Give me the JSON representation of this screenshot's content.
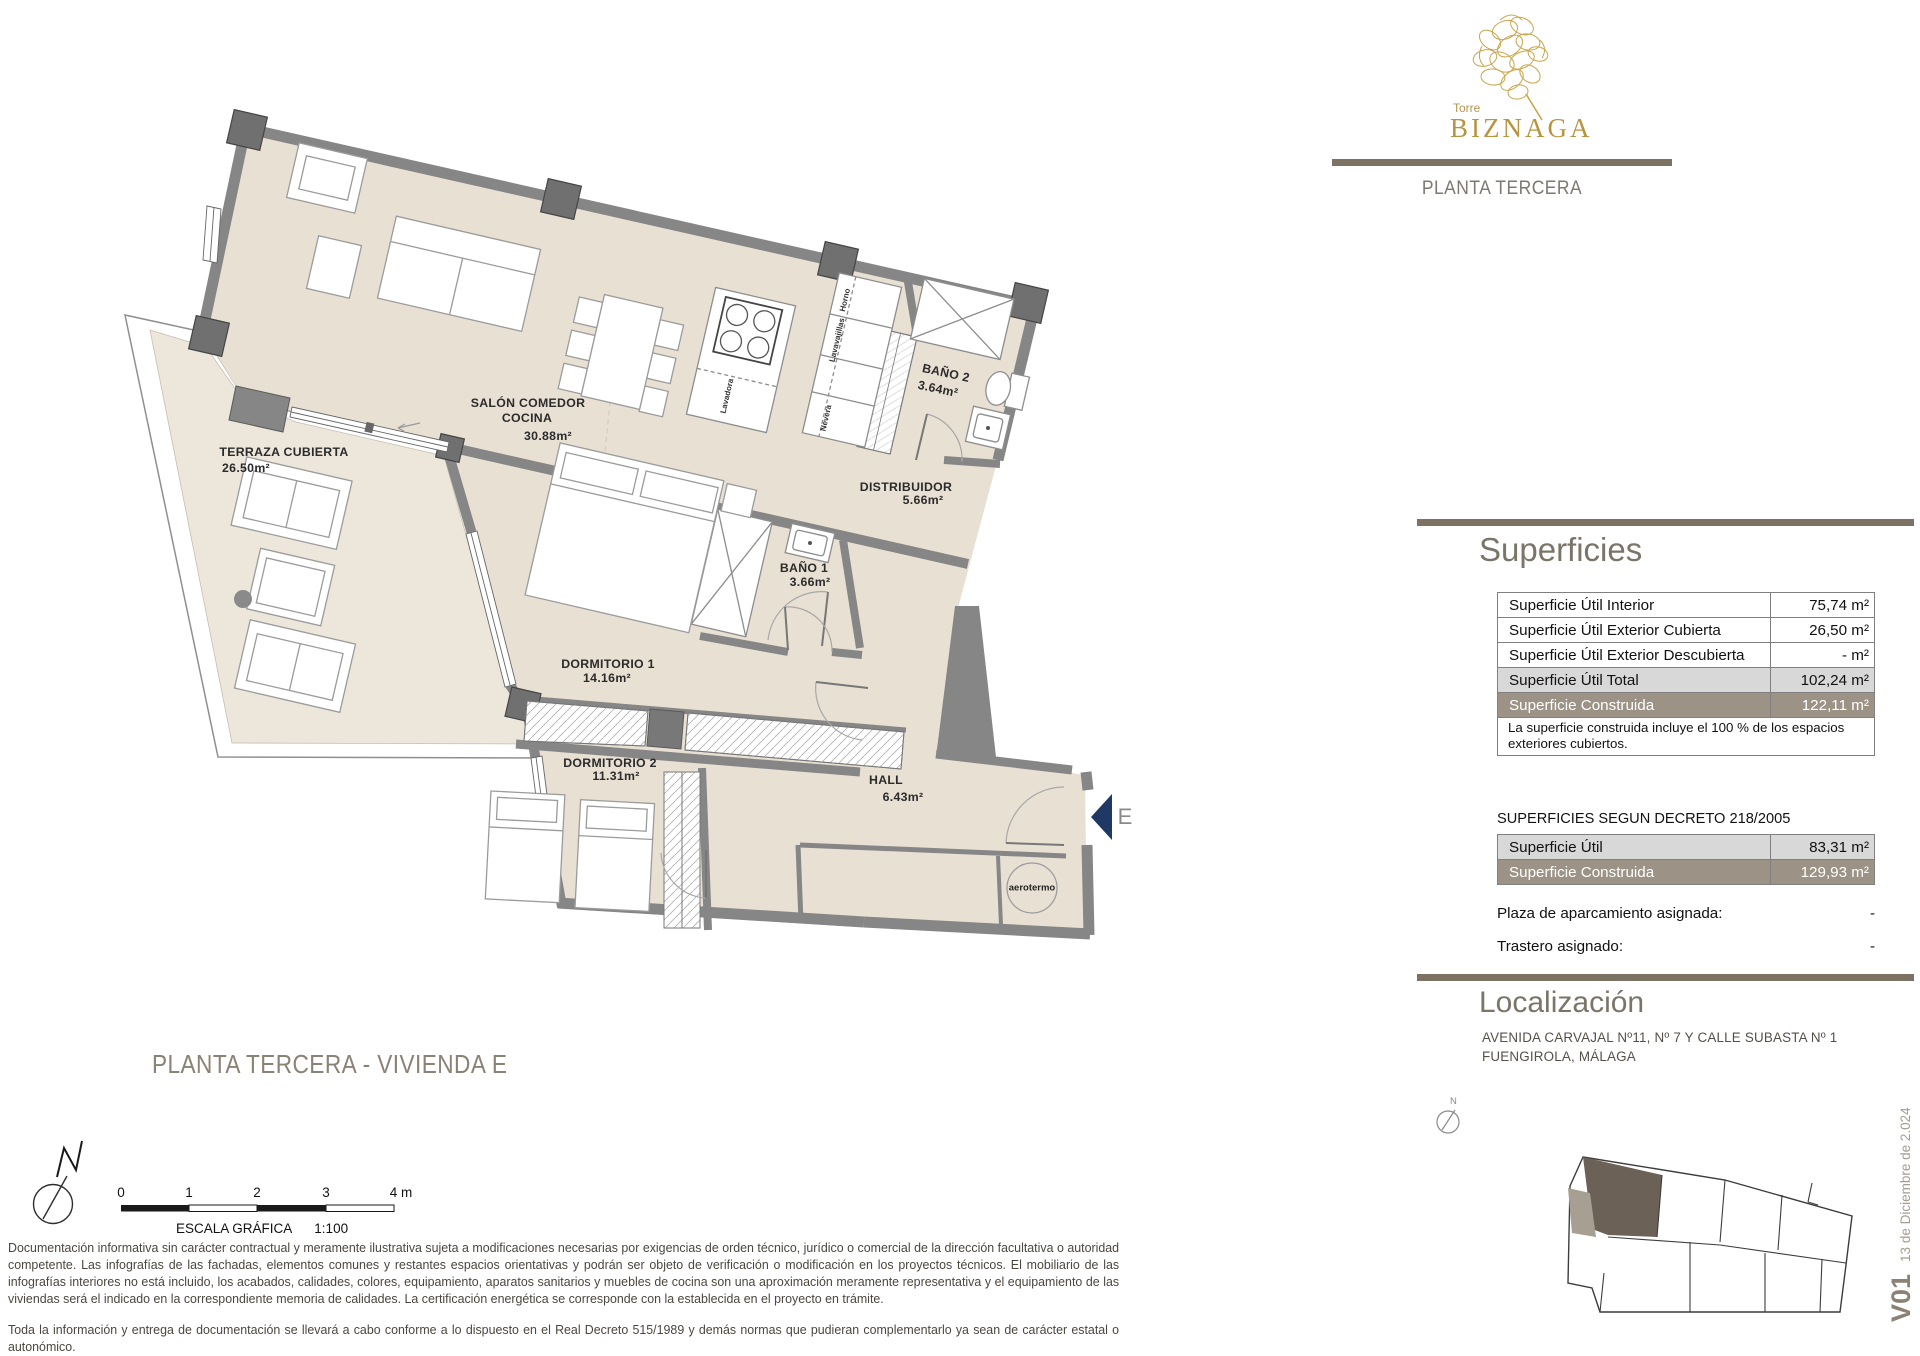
{
  "brand": {
    "logo_small": "Torre",
    "logo_name": "BIZNAGA",
    "floor": "PLANTA TERCERA"
  },
  "plan": {
    "title": "PLANTA TERCERA - VIVIENDA E",
    "entry_label": "E",
    "rooms": [
      {
        "name": "TERRAZA CUBIERTA",
        "area": "26.50m²"
      },
      {
        "name": "SALÓN COMEDOR",
        "name2": "COCINA",
        "area": "30.88m²"
      },
      {
        "name": "BAÑO 2",
        "area": "3.64m²"
      },
      {
        "name": "DISTRIBUIDOR",
        "area": "5.66m²"
      },
      {
        "name": "BAÑO 1",
        "area": "3.66m²"
      },
      {
        "name": "DORMITORIO 1",
        "area": "14.16m²"
      },
      {
        "name": "DORMITORIO 2",
        "area": "11.31m²"
      },
      {
        "name": "HALL",
        "area": "6.43m²"
      }
    ],
    "appliances": {
      "horno": "Horno",
      "lavavajillas": "Lavavajillas",
      "nevera": "Nevera",
      "lavadora": "Lavadora",
      "aerotermo": "aerotermo"
    }
  },
  "scale": {
    "ticks": [
      "0",
      "1",
      "2",
      "3",
      "4 m"
    ],
    "caption": "ESCALA GRÁFICA",
    "ratio": "1:100"
  },
  "superficies": {
    "title": "Superficies",
    "rows": [
      {
        "label": "Superficie Útil Interior",
        "value": "75,74 m²"
      },
      {
        "label": "Superficie Útil Exterior Cubierta",
        "value": "26,50 m²"
      },
      {
        "label": "Superficie Útil Exterior Descubierta",
        "value": "- m²"
      },
      {
        "label": "Superficie Útil Total",
        "value": "102,24 m²"
      },
      {
        "label": "Superficie Construida",
        "value": "122,11 m²"
      }
    ],
    "note": "La superficie construida incluye el 100 % de los espacios exteriores cubiertos.",
    "decreto_title": "SUPERFICIES SEGUN DECRETO 218/2005",
    "decreto_rows": [
      {
        "label": "Superficie Útil",
        "value": "83,31 m²"
      },
      {
        "label": "Superficie Construida",
        "value": "129,93 m²"
      }
    ],
    "assignments": [
      {
        "label": "Plaza de aparcamiento asignada:",
        "value": "-"
      },
      {
        "label": "Trastero asignado:",
        "value": "-"
      }
    ]
  },
  "localizacion": {
    "title": "Localización",
    "line1": "AVENIDA CARVAJAL Nº11, Nº 7 Y CALLE SUBASTA Nº 1",
    "line2": "FUENGIROLA, MÁLAGA"
  },
  "version": {
    "code": "V01",
    "date": "13 de Diciembre de 2.024"
  },
  "compass": {
    "north": "N"
  },
  "legal": {
    "p1": "Documentación informativa sin carácter contractual  y  meramente ilustrativa sujeta  a  modificaciones necesarias por exigencias de orden técnico, jurídico  o  comercial de la dirección facultativa  o  autoridad competente. Las infografías de las fachadas, elementos comunes y restantes espacios orientativas y podrán ser objeto de verificación o modificación en los proyectos técnicos. El mobiliario de las infografías interiores no está incluido, los acabados,  calidades,  colores,  equipamiento,  aparatos sanitarios  y  muebles  de  cocina son una aproximación meramente representativa  y  el equipamiento de  las viviendas será el indicado en la correspondiente memoria de calidades. La certificación energética se corresponde con la establecida en el proyecto en trámite.",
    "p2": "Toda la información y entrega de documentación se llevará a cabo conforme a lo dispuesto en el Real Decreto 515/1989 y demás normas que pudieran complementarlo ya sean de carácter estatal o autonómico."
  },
  "colors": {
    "accent_bar": "#7b7264",
    "table_dark": "#9c9285",
    "table_light": "#d8d8d8",
    "floor": "#e9e0d4",
    "wall": "#868686",
    "navy": "#1f3864",
    "gold": "#b8943f"
  }
}
